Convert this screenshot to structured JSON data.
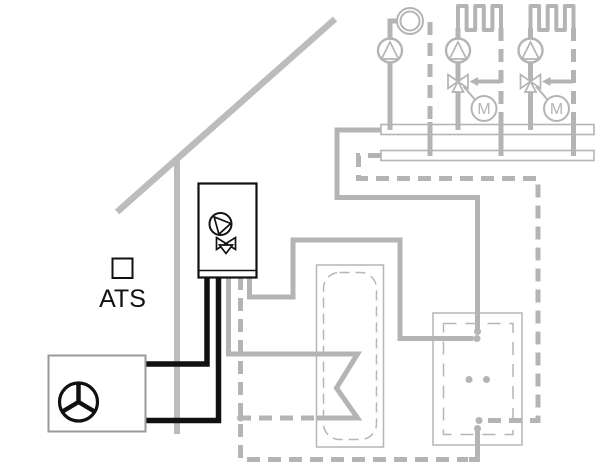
{
  "diagram": {
    "type": "heating-system-schematic",
    "labels": {
      "outdoor_sensor": "ATS",
      "mixing_valve_motor": "M"
    },
    "colors": {
      "pipe_gray": "#b4b4b4",
      "house_gray": "#bcbcbc",
      "tank_outline_gray": "#b6b6b6",
      "black": "#111111",
      "outdoor_unit_border": "#9a9a9a",
      "background": "#ffffff"
    },
    "components": [
      "house-outline",
      "outdoor-temperature-sensor",
      "outdoor-unit-with-fan",
      "indoor-unit-with-pump-and-diverter-valve",
      "dhw-cylinder-with-coil",
      "buffer-tank",
      "supply-manifold",
      "return-manifold",
      "heating-circuit-1-pump-circulation",
      "heating-circuit-2-radiator-mixed",
      "heating-circuit-3-radiator-mixed"
    ]
  }
}
